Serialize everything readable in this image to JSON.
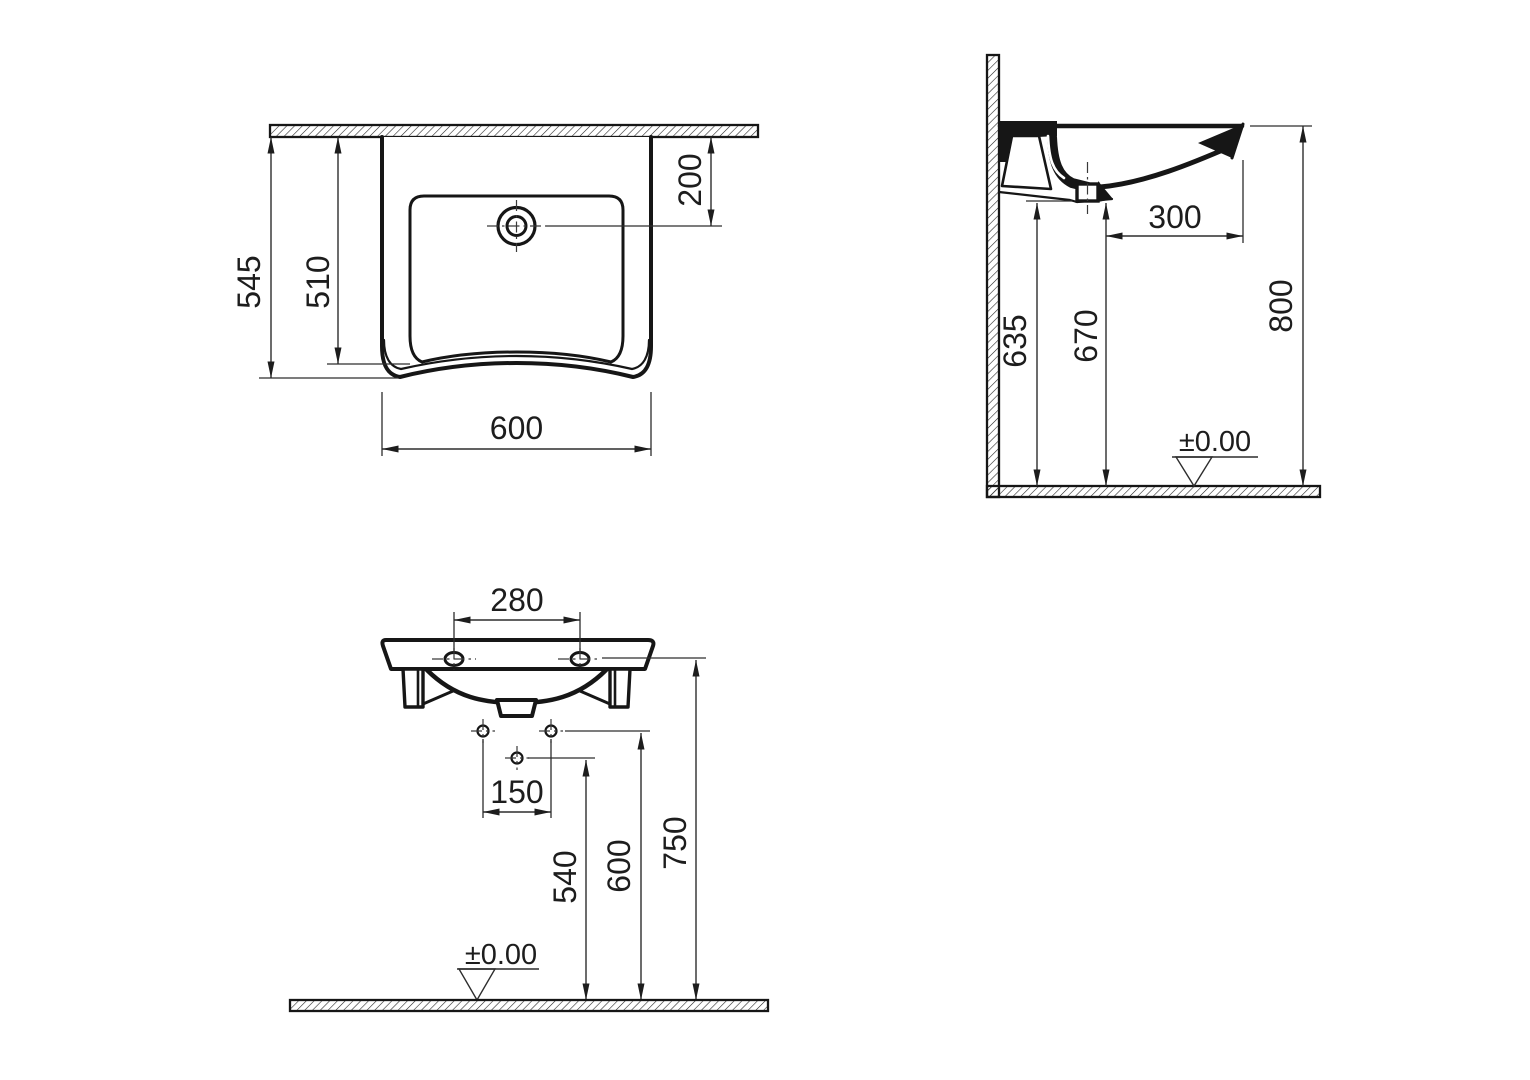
{
  "drawing": {
    "plan": {
      "depth_overall": "545",
      "depth_bowl": "510",
      "tap_offset": "200",
      "width": "600"
    },
    "side": {
      "drain_offset": "300",
      "h_underside": "635",
      "h_drain": "670",
      "h_rim": "800",
      "datum": "±0.00"
    },
    "front": {
      "tap_spacing": "280",
      "fixing_spacing": "150",
      "h_trap": "540",
      "h_fixing": "600",
      "h_rim_line": "750",
      "datum": "±0.00"
    },
    "colors": {
      "line": "#161616",
      "thin_line": "#2d2d2d",
      "background": "#ffffff"
    }
  }
}
